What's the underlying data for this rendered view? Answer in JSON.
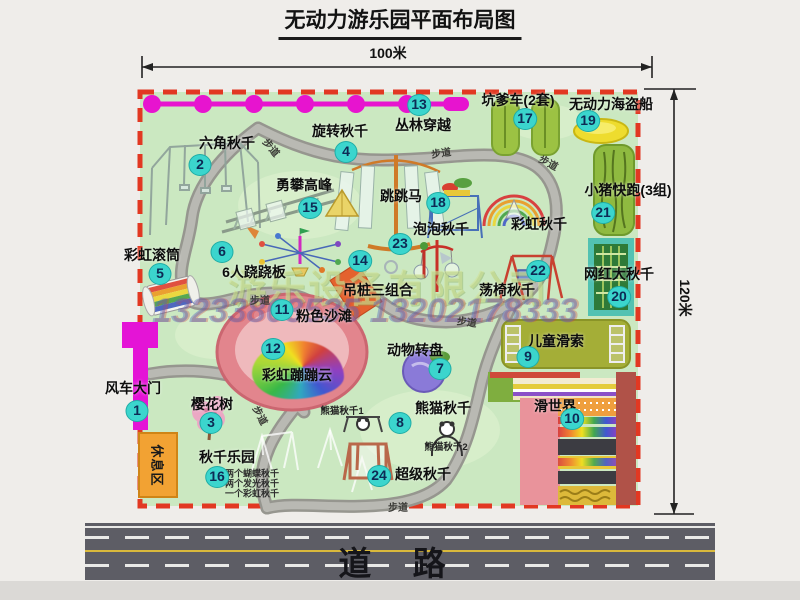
{
  "title": "无动力游乐园平面布局图",
  "dim_width": "100米",
  "dim_height": "120米",
  "road_label": "道 路",
  "rest_area_label": "休息区",
  "watermark": {
    "company": "游乐设备有限公司",
    "phone": "13233803535 13202178333"
  },
  "colors": {
    "map_fill": "#cbe8c1",
    "border_red": "#e23822",
    "badge": "#3bd5cd",
    "walkway": "#96968f",
    "chain_magenta": "#e714cf",
    "gate_magenta": "#e414d6",
    "rest_orange": "#f2a233",
    "road_gray": "#5d5d65",
    "pirate_yellow": "#eedc2e"
  },
  "attractions": [
    {
      "num": "1",
      "label": "风车大门",
      "label_x": 133,
      "label_y": 388,
      "badge_x": 137,
      "badge_y": 411
    },
    {
      "num": "2",
      "label": "六角秋千",
      "label_x": 227,
      "label_y": 143,
      "badge_x": 200,
      "badge_y": 165
    },
    {
      "num": "3",
      "label": "樱花树",
      "label_x": 212,
      "label_y": 404,
      "badge_x": 211,
      "badge_y": 423
    },
    {
      "num": "4",
      "label": "旋转秋千",
      "label_x": 340,
      "label_y": 131,
      "badge_x": 346,
      "badge_y": 152
    },
    {
      "num": "5",
      "label": "彩虹滚筒",
      "label_x": 152,
      "label_y": 255,
      "badge_x": 160,
      "badge_y": 274
    },
    {
      "num": "6",
      "label": "6人跷跷板",
      "label_x": 254,
      "label_y": 272,
      "badge_x": 222,
      "badge_y": 252
    },
    {
      "num": "7",
      "label": "动物转盘",
      "label_x": 415,
      "label_y": 350,
      "badge_x": 440,
      "badge_y": 369
    },
    {
      "num": "8",
      "label": "熊猫秋千",
      "label_x": 443,
      "label_y": 408,
      "badge_x": 400,
      "badge_y": 423
    },
    {
      "num": "9",
      "label": "儿童滑索",
      "label_x": 556,
      "label_y": 341,
      "badge_x": 528,
      "badge_y": 357
    },
    {
      "num": "10",
      "label": "滑世界",
      "label_x": 555,
      "label_y": 406,
      "badge_x": 572,
      "badge_y": 419
    },
    {
      "num": "11",
      "label": "粉色沙滩",
      "label_x": 324,
      "label_y": 316,
      "badge_x": 282,
      "badge_y": 310
    },
    {
      "num": "12",
      "label": "彩虹蹦蹦云",
      "label_x": 297,
      "label_y": 375,
      "badge_x": 273,
      "badge_y": 349
    },
    {
      "num": "13",
      "label": "丛林穿越",
      "label_x": 423,
      "label_y": 125,
      "badge_x": 419,
      "badge_y": 105
    },
    {
      "num": "14",
      "label": "吊桩三组合",
      "label_x": 378,
      "label_y": 290,
      "badge_x": 360,
      "badge_y": 261
    },
    {
      "num": "15",
      "label": "勇攀高峰",
      "label_x": 304,
      "label_y": 185,
      "badge_x": 310,
      "badge_y": 208
    },
    {
      "num": "16",
      "label": "秋千乐园",
      "label_x": 227,
      "label_y": 457,
      "badge_x": 217,
      "badge_y": 477
    },
    {
      "num": "17",
      "label": "坑爹车(2套)",
      "label_x": 518,
      "label_y": 100,
      "badge_x": 525,
      "badge_y": 119
    },
    {
      "num": "18",
      "label": "跳跳马",
      "label_x": 401,
      "label_y": 196,
      "badge_x": 438,
      "badge_y": 203
    },
    {
      "num": "19",
      "label": "无动力海盗船",
      "label_x": 611,
      "label_y": 104,
      "badge_x": 588,
      "badge_y": 121
    },
    {
      "num": "20",
      "label": "网红大秋千",
      "label_x": 619,
      "label_y": 274,
      "badge_x": 619,
      "badge_y": 297
    },
    {
      "num": "21",
      "label": "小猪快跑(3组)",
      "label_x": 628,
      "label_y": 190,
      "badge_x": 603,
      "badge_y": 213
    },
    {
      "num": "22",
      "label": "荡椅秋千",
      "label_x": 507,
      "label_y": 290,
      "badge_x": 538,
      "badge_y": 271
    },
    {
      "num": "23",
      "label": "泡泡秋千",
      "label_x": 441,
      "label_y": 229,
      "badge_x": 400,
      "badge_y": 244
    },
    {
      "num": "24",
      "label": "超级秋千",
      "label_x": 423,
      "label_y": 474,
      "badge_x": 379,
      "badge_y": 476
    },
    {
      "num": "",
      "label": "彩虹秋千",
      "label_x": 539,
      "label_y": 224
    }
  ],
  "sub_labels": [
    {
      "text": "熊猫秋千1",
      "x": 342,
      "y": 410
    },
    {
      "text": "熊猫秋千2",
      "x": 446,
      "y": 446
    }
  ],
  "swing_park_notes": [
    {
      "text": "两个蝴蝶秋千",
      "x": 252,
      "y": 473
    },
    {
      "text": "两个发光秋千",
      "x": 252,
      "y": 483
    },
    {
      "text": "一个彩虹秋千",
      "x": 252,
      "y": 493
    }
  ],
  "path_labels": [
    {
      "text": "步道",
      "x": 272,
      "y": 147,
      "rot": 50
    },
    {
      "text": "步道",
      "x": 441,
      "y": 152,
      "rot": -8
    },
    {
      "text": "步道",
      "x": 549,
      "y": 162,
      "rot": 28
    },
    {
      "text": "步道",
      "x": 250,
      "y": 292,
      "rot": 0
    },
    {
      "text": "步道",
      "x": 467,
      "y": 321,
      "rot": 8
    },
    {
      "text": "步道",
      "x": 261,
      "y": 415,
      "rot": 62
    },
    {
      "text": "步道",
      "x": 388,
      "y": 499,
      "rot": 0
    }
  ],
  "icons": [
    "windmill-gate-icon",
    "hex-swing-icon",
    "rotating-swing-icon",
    "climbing-icon",
    "rainbow-roller-icon",
    "seesaw-icon",
    "jumping-horse-icon",
    "bubble-swing-icon",
    "rainbow-swing-icon",
    "swing-chair-icon",
    "web-swing-icon",
    "piggy-run-icon",
    "kengdie-car-icon",
    "pirate-ship-icon",
    "hanging-pile-icon",
    "pink-beach-icon",
    "bounce-cloud-icon",
    "cherry-tree-icon",
    "panda-swing-icon",
    "super-swing-icon",
    "kids-zipline-icon",
    "slide-world-icon",
    "animal-turntable-icon",
    "jungle-zipline-icon"
  ]
}
